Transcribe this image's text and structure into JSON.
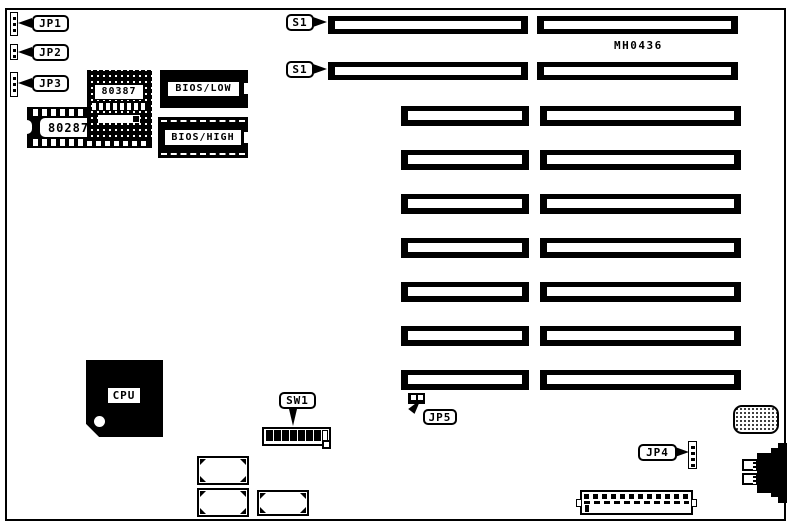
{
  "colors": {
    "ink": "#000000",
    "paper": "#ffffff"
  },
  "labels": {
    "jp1": "JP1",
    "jp2": "JP2",
    "jp3": "JP3",
    "jp4": "JP4",
    "jp5": "JP5",
    "s1_slot1": "S1",
    "s1_slot2": "S1",
    "sw1": "SW1",
    "coprocessor_80387": "80387",
    "coprocessor_80287": "80287",
    "bios_low": "BIOS/LOW",
    "bios_high": "BIOS/HIGH",
    "cpu": "CPU",
    "part_number": "MH0436"
  }
}
